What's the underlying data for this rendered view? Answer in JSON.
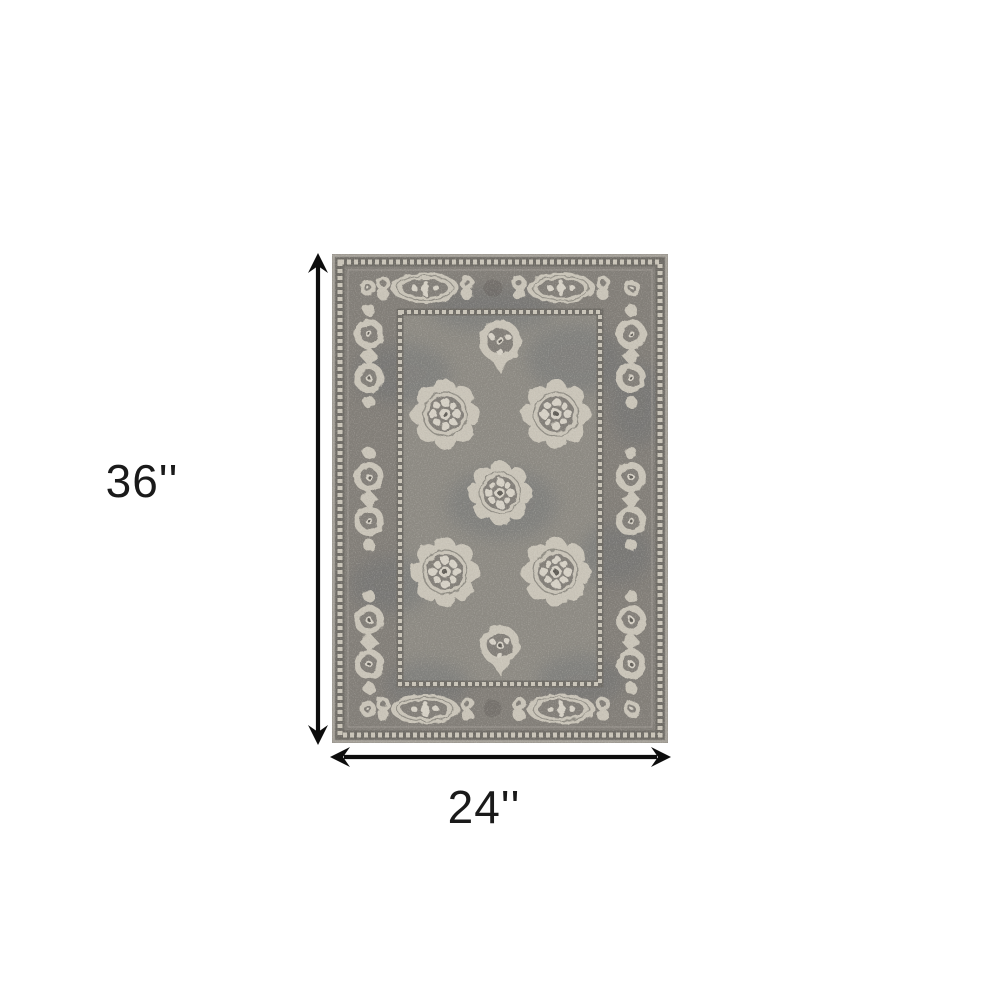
{
  "diagram": {
    "type": "product-dimension-diagram",
    "item": "traditional-ornate-gray-area-rug",
    "height_label": "36''",
    "width_label": "24''"
  },
  "colors": {
    "dimension": "#0d0d0d",
    "label_text": "#1a1a1a",
    "page_bg": "#ffffff",
    "rug_field": "#8d8a83",
    "rug_band": "#827e78",
    "rug_cream": "#cac5b9",
    "rug_cream_bright": "#d7d2c7",
    "rug_dark": "#5e5c57",
    "rug_slate": "#5f666d",
    "rug_guard_dark": "#6e6b65",
    "rug_edge": "#a7a39b"
  }
}
